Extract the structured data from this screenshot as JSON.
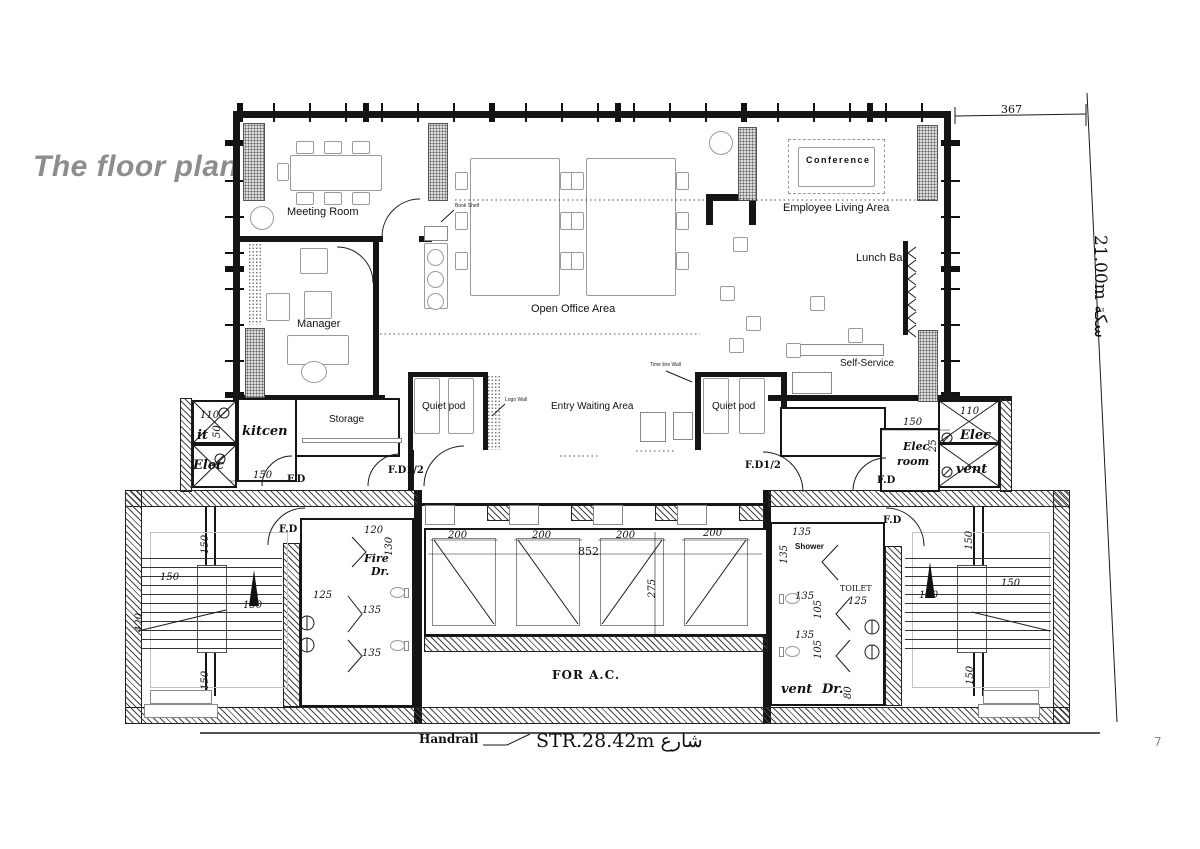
{
  "title": "The floor plan",
  "page_number": "7",
  "colors": {
    "title_gray": "#8d8d8d",
    "line": "#1a1a1a",
    "pier_fill": "#dcdcdc"
  },
  "plan": {
    "labels": [
      {
        "n": "meeting-room",
        "t": "Meeting Room",
        "x": 287,
        "y": 206,
        "c": "room"
      },
      {
        "n": "manager",
        "t": "Manager",
        "x": 297,
        "y": 318,
        "c": "room"
      },
      {
        "n": "open-office-area",
        "t": "Open Office Area",
        "x": 531,
        "y": 303,
        "c": "room"
      },
      {
        "n": "conference",
        "t": "Conference",
        "x": 806,
        "y": 155,
        "c": "conf"
      },
      {
        "n": "employee-living-area",
        "t": "Employee Living Area",
        "x": 783,
        "y": 202,
        "c": "room"
      },
      {
        "n": "lunch-bar",
        "t": "Lunch Bar",
        "x": 856,
        "y": 252,
        "c": "room"
      },
      {
        "n": "self-service",
        "t": "Self-Service",
        "x": 840,
        "y": 358,
        "c": "room-s"
      },
      {
        "n": "entry-waiting-area",
        "t": "Entry Waiting Area",
        "x": 551,
        "y": 401,
        "c": "room-s"
      },
      {
        "n": "quiet-pod-left",
        "t": "Quiet pod",
        "x": 422,
        "y": 401,
        "c": "room-s"
      },
      {
        "n": "quiet-pod-right",
        "t": "Quiet pod",
        "x": 712,
        "y": 401,
        "c": "room-s"
      },
      {
        "n": "storage",
        "t": "Storage",
        "x": 329,
        "y": 414,
        "c": "room-s"
      },
      {
        "n": "kitcen",
        "t": "kitcen",
        "x": 242,
        "y": 424,
        "c": "serifbi"
      },
      {
        "n": "book-shelf",
        "t": "Book Shelf",
        "x": 455,
        "y": 203,
        "c": "tiny"
      },
      {
        "n": "logo-wall",
        "t": "Logo Wall",
        "x": 505,
        "y": 397,
        "c": "tiny"
      },
      {
        "n": "time-line-wall",
        "t": "Time line Wall",
        "x": 650,
        "y": 362,
        "c": "tiny"
      },
      {
        "n": "it-shaft",
        "t": "it",
        "x": 197,
        "y": 428,
        "c": "serifbi"
      },
      {
        "n": "elec-shaft-left",
        "t": "Elec",
        "x": 193,
        "y": 458,
        "c": "serifbi"
      },
      {
        "n": "elec-shaft-right",
        "t": "Elec",
        "x": 960,
        "y": 428,
        "c": "serifbi"
      },
      {
        "n": "vent-shaft-right",
        "t": "vent",
        "x": 956,
        "y": 462,
        "c": "serifbi"
      },
      {
        "n": "elec-room-line1",
        "t": "Elec",
        "x": 903,
        "y": 440,
        "c": "serifbi-s"
      },
      {
        "n": "elec-room-line2",
        "t": "room",
        "x": 897,
        "y": 455,
        "c": "serifbi-s"
      },
      {
        "n": "vent-room",
        "t": "vent",
        "x": 781,
        "y": 682,
        "c": "serifbi"
      },
      {
        "n": "dr-room",
        "t": "Dr.",
        "x": 822,
        "y": 682,
        "c": "serifbi"
      },
      {
        "n": "fire-line1",
        "t": "Fire",
        "x": 364,
        "y": 552,
        "c": "serifbi-s"
      },
      {
        "n": "fire-line2",
        "t": "Dr.",
        "x": 371,
        "y": 565,
        "c": "serifbi-s"
      },
      {
        "n": "shower",
        "t": "Shower",
        "x": 795,
        "y": 542,
        "c": "bold-xs"
      },
      {
        "n": "toilet",
        "t": "TOILET",
        "x": 840,
        "y": 584,
        "c": "serif-xs"
      },
      {
        "n": "fd-storage",
        "t": "F.D",
        "x": 287,
        "y": 474,
        "c": "fd"
      },
      {
        "n": "fd12-left",
        "t": "F.D1/2",
        "x": 388,
        "y": 465,
        "c": "fd"
      },
      {
        "n": "fd12-right",
        "t": "F.D1/2",
        "x": 745,
        "y": 460,
        "c": "fd"
      },
      {
        "n": "fd-elec-room",
        "t": "F.D",
        "x": 877,
        "y": 475,
        "c": "fd"
      },
      {
        "n": "fd-stair-left",
        "t": "F.D",
        "x": 279,
        "y": 524,
        "c": "fd"
      },
      {
        "n": "fd-stair-right",
        "t": "F.D",
        "x": 883,
        "y": 515,
        "c": "fd"
      },
      {
        "n": "dim-110-left",
        "t": "110",
        "x": 200,
        "y": 410,
        "c": "dim"
      },
      {
        "n": "dim-50-left",
        "t": "50",
        "x": 212,
        "y": 438,
        "c": "dimv"
      },
      {
        "n": "dim-150-storage",
        "t": "150",
        "x": 253,
        "y": 470,
        "c": "dim"
      },
      {
        "n": "dim-150-elecroom",
        "t": "150",
        "x": 903,
        "y": 417,
        "c": "dim"
      },
      {
        "n": "dim-110-right",
        "t": "110",
        "x": 960,
        "y": 406,
        "c": "dim"
      },
      {
        "n": "dim-25-right",
        "t": "25",
        "x": 928,
        "y": 452,
        "c": "dimv"
      },
      {
        "n": "dim-200-shaft1",
        "t": "200",
        "x": 448,
        "y": 530,
        "c": "dim"
      },
      {
        "n": "dim-200-shaft2",
        "t": "200",
        "x": 532,
        "y": 530,
        "c": "dim"
      },
      {
        "n": "dim-200-shaft3",
        "t": "200",
        "x": 616,
        "y": 530,
        "c": "dim"
      },
      {
        "n": "dim-200-shaft4",
        "t": "200",
        "x": 703,
        "y": 528,
        "c": "dim"
      },
      {
        "n": "dim-852",
        "t": "852",
        "x": 578,
        "y": 545,
        "c": "dim-lg"
      },
      {
        "n": "dim-275",
        "t": "275",
        "x": 647,
        "y": 598,
        "c": "dimv"
      },
      {
        "n": "dim-150-lstair-1",
        "t": "150",
        "x": 160,
        "y": 572,
        "c": "dim"
      },
      {
        "n": "dim-150-lstair-2",
        "t": "150",
        "x": 200,
        "y": 554,
        "c": "dimv"
      },
      {
        "n": "dim-150-lstair-3",
        "t": "150",
        "x": 243,
        "y": 600,
        "c": "dim"
      },
      {
        "n": "dim-420-lstair",
        "t": "420",
        "x": 134,
        "y": 632,
        "c": "dimv"
      },
      {
        "n": "dim-150-lstair-4",
        "t": "150",
        "x": 200,
        "y": 690,
        "c": "dimv"
      },
      {
        "n": "dim-120",
        "t": "120",
        "x": 364,
        "y": 525,
        "c": "dim"
      },
      {
        "n": "dim-130",
        "t": "130",
        "x": 384,
        "y": 556,
        "c": "dimv"
      },
      {
        "n": "dim-125-left",
        "t": "125",
        "x": 313,
        "y": 590,
        "c": "dim"
      },
      {
        "n": "dim-135-left-1",
        "t": "135",
        "x": 362,
        "y": 605,
        "c": "dim"
      },
      {
        "n": "dim-135-left-2",
        "t": "135",
        "x": 362,
        "y": 648,
        "c": "dim"
      },
      {
        "n": "dim-135-right-1",
        "t": "135",
        "x": 792,
        "y": 527,
        "c": "dim"
      },
      {
        "n": "dim-135-right-2",
        "t": "135",
        "x": 779,
        "y": 564,
        "c": "dimv"
      },
      {
        "n": "dim-125-right",
        "t": "125",
        "x": 848,
        "y": 596,
        "c": "dim"
      },
      {
        "n": "dim-135-right-3",
        "t": "135",
        "x": 795,
        "y": 591,
        "c": "dim"
      },
      {
        "n": "dim-105-right-1",
        "t": "105",
        "x": 813,
        "y": 619,
        "c": "dimv"
      },
      {
        "n": "dim-135-right-4",
        "t": "135",
        "x": 795,
        "y": 630,
        "c": "dim"
      },
      {
        "n": "dim-105-right-2",
        "t": "105",
        "x": 813,
        "y": 659,
        "c": "dimv"
      },
      {
        "n": "dim-80",
        "t": "80",
        "x": 843,
        "y": 699,
        "c": "dimv"
      },
      {
        "n": "dim-150-rstair-1",
        "t": "150",
        "x": 964,
        "y": 550,
        "c": "dimv"
      },
      {
        "n": "dim-150-rstair-2",
        "t": "150",
        "x": 1001,
        "y": 578,
        "c": "dim"
      },
      {
        "n": "dim-150-rstair-3",
        "t": "150",
        "x": 919,
        "y": 590,
        "c": "dim"
      },
      {
        "n": "dim-150-rstair-4",
        "t": "150",
        "x": 965,
        "y": 685,
        "c": "dimv"
      },
      {
        "n": "for-ac",
        "t": "FOR  A.C.",
        "x": 552,
        "y": 668,
        "c": "forac"
      },
      {
        "n": "handrail",
        "t": "Handrail",
        "x": 419,
        "y": 732,
        "c": "handrail"
      },
      {
        "n": "street",
        "t": "STR.28.42m شارع",
        "x": 536,
        "y": 730,
        "c": "street"
      },
      {
        "n": "dim-367",
        "t": "367",
        "x": 1001,
        "y": 103,
        "c": "dim-lg"
      },
      {
        "n": "site-edge",
        "t": "21.00m سكة",
        "x": 1110,
        "y": 235,
        "c": "site"
      }
    ]
  }
}
